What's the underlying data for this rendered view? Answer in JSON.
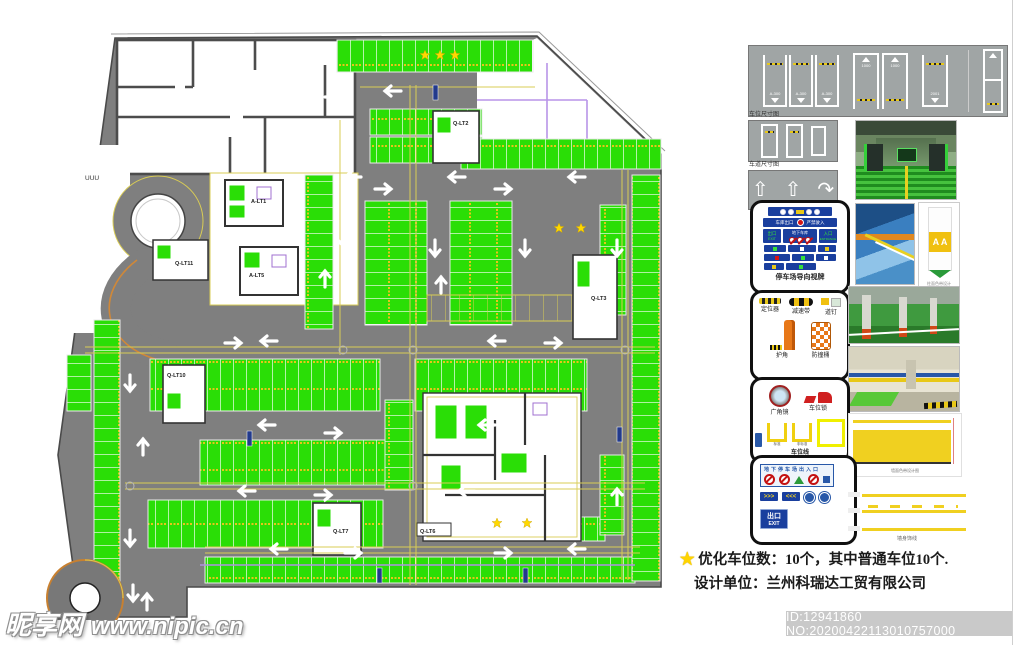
{
  "plan": {
    "cores": {
      "alt1": "A-LT1",
      "alt5": "A-LT5",
      "qlt11": "Q-LT11",
      "qlt2": "Q-LT2",
      "qlt3": "Q-LT3",
      "qlt10": "Q-LT10",
      "qlt7": "Q-LT7",
      "qlt6": "Q-LT6"
    },
    "misc_label": "UUU"
  },
  "sidebar": {
    "dim_panels": {
      "caption_a": "车位尺寸图",
      "caption_b": "车道尺寸图",
      "stall_labels": [
        "A-300",
        "A-300",
        "A-300",
        "1000",
        "1000",
        "2001"
      ]
    },
    "signage": {
      "caption": "停车场导向视牌",
      "garage_exit": "车库出口",
      "no_entry": "严禁驶入",
      "exit": "出口",
      "exit_en": "EXIT",
      "underground": "地下车库",
      "entrance": "入口",
      "entrance_en": "ENTRANCE"
    },
    "facilities": {
      "items": [
        {
          "label": "定位器"
        },
        {
          "label": "减速带"
        },
        {
          "label": "道钉"
        },
        {
          "label": "护角"
        },
        {
          "label": "防撞桶"
        }
      ]
    },
    "accessories": {
      "mirror": "广角镜",
      "lock": "车位锁",
      "std": "标准",
      "nonstd": "非标准",
      "line": "车位线"
    },
    "entrance_panel": {
      "title": "地下停车场出入口",
      "chip_r": ">>>",
      "chip_l": "<<<",
      "exit": "出口",
      "exit_en": "EXIT"
    },
    "column_card": {
      "letters": "A A",
      "caption": "柱面色带设计"
    },
    "wall_band": {
      "caption": "墙面色带设计图"
    },
    "stripes": {
      "caption": "墙身饰线"
    }
  },
  "notes": {
    "star": "★",
    "line1": "优化车位数：10个，其中普通车位10个.",
    "line2": "设计单位：兰州科瑞达工贸有限公司"
  },
  "watermark": {
    "site": "昵享网",
    "url": "www.nipic.cn"
  },
  "id_bar": {
    "text": "ID:12941860 NO:20200422113010757000"
  },
  "colors": {
    "stall_green": "#2ade06",
    "road_gray": "#7f7f7f",
    "accent_yellow": "#e6c619",
    "sign_blue": "#1a3f9e"
  }
}
